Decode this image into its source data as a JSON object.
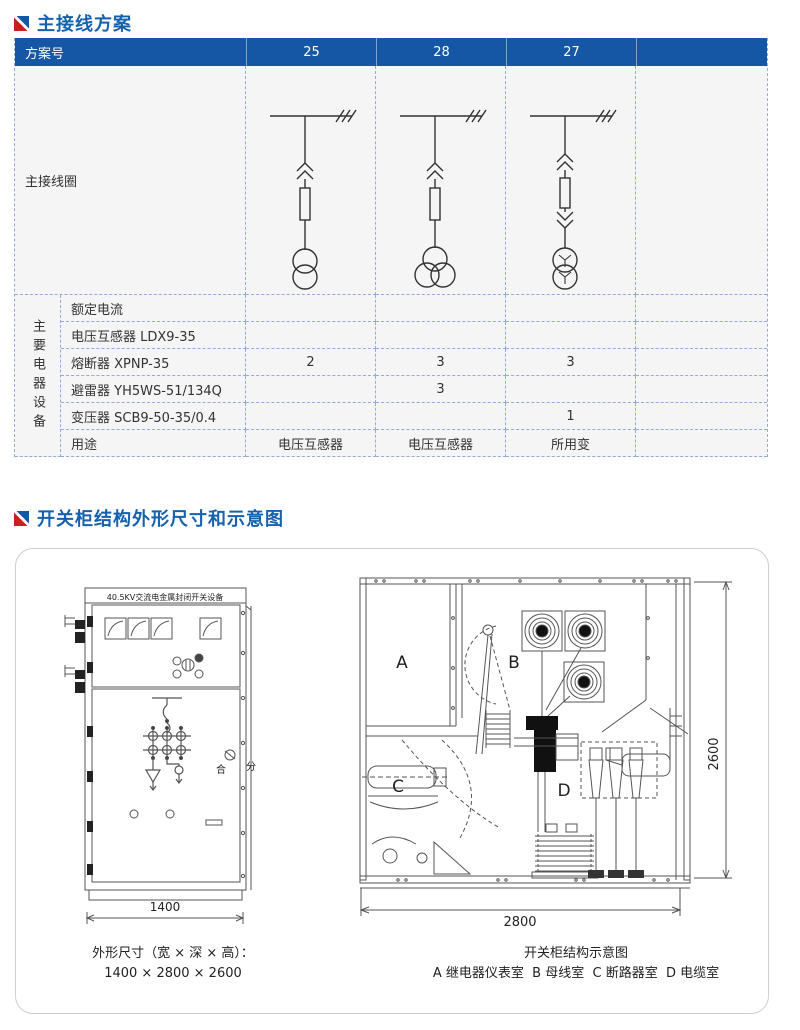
{
  "colors": {
    "header_blue": "#1556a5",
    "title_blue": "#1561ad",
    "accent_red": "#cc1e1e",
    "cell_bg": "#f5f5f6",
    "dash_border": "#93abd7"
  },
  "section1": {
    "title": "主接线方案",
    "table": {
      "scheme_label": "方案号",
      "schemes": [
        "25",
        "28",
        "27",
        ""
      ],
      "diagram_label": "主接线圈",
      "group_label": "主要电器设备",
      "rows": [
        {
          "label": "额定电流",
          "values": [
            "",
            "",
            "",
            ""
          ]
        },
        {
          "label": "电压互感器 LDX9-35",
          "values": [
            "",
            "",
            "",
            ""
          ]
        },
        {
          "label": "熔断器 XPNP-35",
          "values": [
            "2",
            "3",
            "3",
            ""
          ]
        },
        {
          "label": "避雷器 YH5WS-51/134Q",
          "values": [
            "",
            "3",
            "",
            ""
          ]
        },
        {
          "label": "变压器 SCB9-50-35/0.4",
          "values": [
            "",
            "",
            "1",
            ""
          ]
        },
        {
          "label": "用途",
          "values": [
            "电压互感器",
            "电压互感器",
            "所用变",
            ""
          ]
        }
      ]
    }
  },
  "section2": {
    "title": "开关柜结构外形尺寸和示意图",
    "cabinet": {
      "nameplate": "40.5KV交流电金属封闭开关设备",
      "close_label": "合",
      "open_label": "分",
      "width_dim": "1400"
    },
    "structure": {
      "rooms": [
        "A",
        "B",
        "C",
        "D"
      ],
      "height_dim": "2600",
      "depth_dim": "2800"
    },
    "captions": {
      "left_line1": "外形尺寸（宽 × 深 × 高）：",
      "left_line2": "1400 × 2800 × 2600",
      "right_line1": "开关柜结构示意图",
      "right_line2": "A 继电器仪表室  B 母线室  C 断路器室  D 电缆室"
    }
  }
}
